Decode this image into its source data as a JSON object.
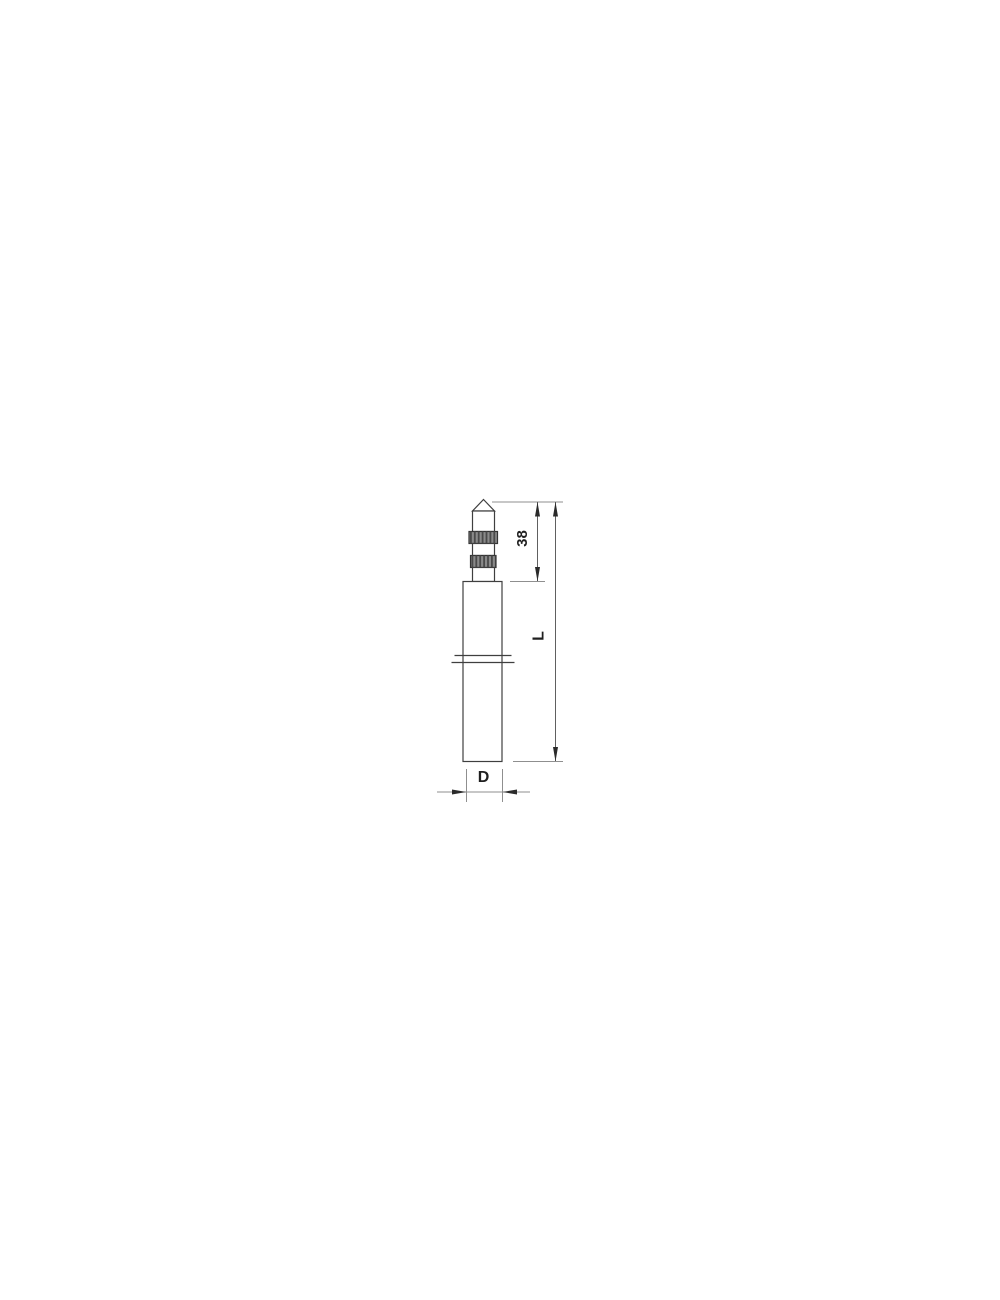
{
  "diagram": {
    "labels": {
      "tip_length": "38",
      "overall_length": "L",
      "diameter": "D"
    },
    "colors": {
      "background": "#ffffff",
      "outline": "#3f3f3f",
      "dimension_line": "#606060",
      "extension_line": "#8f8f8f",
      "arrowhead": "#2b2b2b",
      "label_text": "#1f1f1f",
      "knurl_fill": "#8a8a8a",
      "knurl_stripe": "#4a4a4a"
    }
  }
}
